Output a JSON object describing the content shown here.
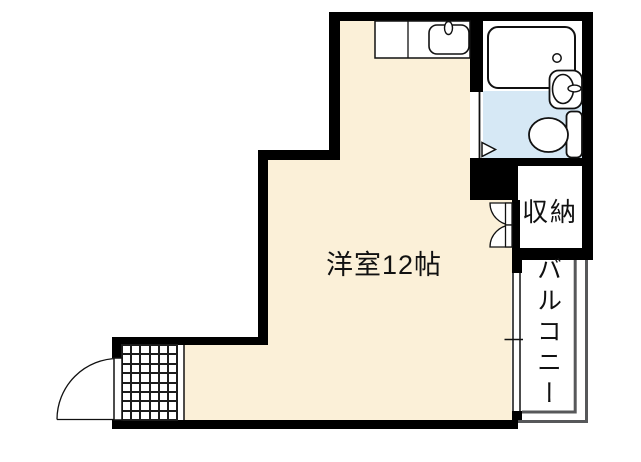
{
  "floor_plan": {
    "labels": {
      "room": "洋室12帖",
      "closet": "収納",
      "balcony": "バルコニー"
    },
    "colors": {
      "floor": "#FBF0D8",
      "wet_area": "#D6E8F5",
      "wall": "#000000",
      "balcony_line": "#57585A",
      "tile_line": "#1C1C1C"
    },
    "fixtures": {
      "kitchen": "kitchen-counter-with-sink",
      "bath": "bathtub",
      "sanitary": "toilet-and-washbasin",
      "entrance": "tiled-genkan-with-door",
      "storage": "double-door-closet",
      "opening": "sliding-window-to-balcony"
    }
  }
}
